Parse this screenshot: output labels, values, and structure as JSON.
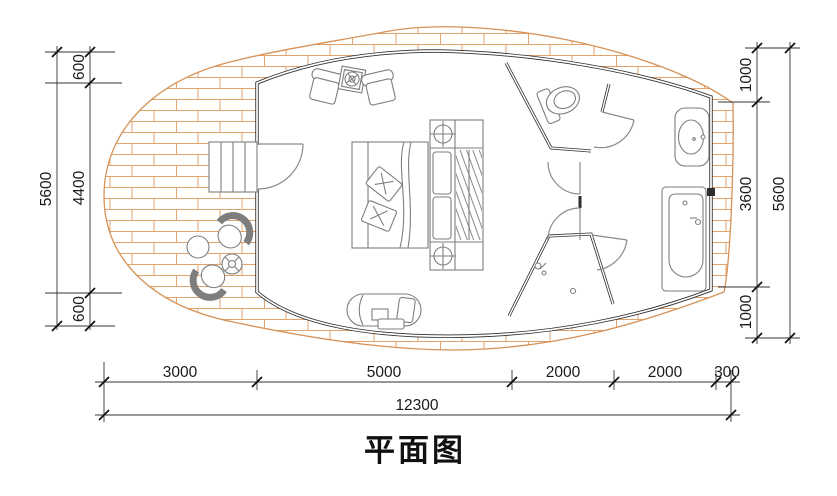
{
  "title": "平面图",
  "dims": {
    "left": {
      "total": "5600",
      "segments": [
        "600",
        "4400",
        "600"
      ]
    },
    "right": {
      "total": "5600",
      "segments": [
        "1000",
        "3600",
        "1000"
      ]
    },
    "bottom": {
      "total": "12300",
      "segments": [
        "3000",
        "5000",
        "2000",
        "2000",
        "300"
      ]
    }
  },
  "fixtures": [
    "deck-paving",
    "stairs",
    "entry-door",
    "armchair",
    "side-table",
    "bed",
    "wardrobe",
    "chaise-longue",
    "outdoor-chair",
    "round-table",
    "potted-plant",
    "toilet",
    "shower",
    "wash-basin",
    "bathtub"
  ],
  "colors": {
    "brick_line": "#e2a36c",
    "deck_outline": "#d69257",
    "wall": "#2e2e2e",
    "furniture_line": "#7e7e7e",
    "dimension_text": "#1a1a1a"
  }
}
